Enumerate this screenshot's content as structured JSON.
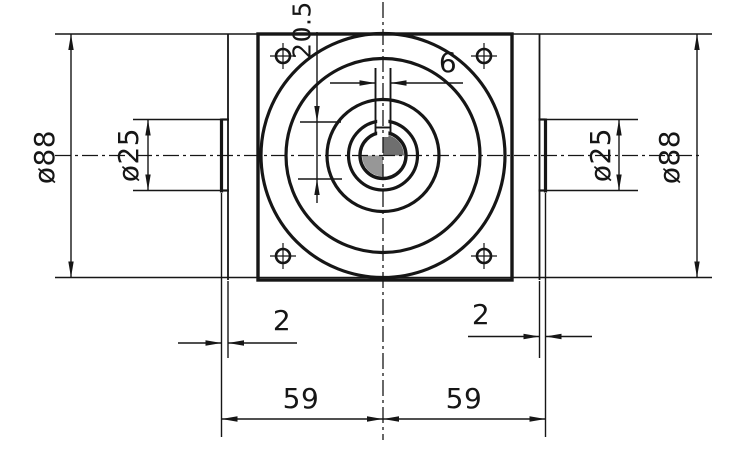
{
  "drawing": {
    "type": "engineering-dimension-drawing",
    "view": "front-view-square-flange-gearbox",
    "labels": {
      "od_left": "ø88",
      "od_right": "ø88",
      "hub_left": "ø25",
      "hub_right": "ø25",
      "keyway_width": "6",
      "keyway_depth": "20.5",
      "step_left": "2",
      "step_right": "2",
      "span_left": "59",
      "span_right": "59"
    },
    "colors": {
      "line": "#161616",
      "background": "#ffffff",
      "bore_shade_dark": "#6f6f6f",
      "bore_shade_light": "#979797"
    }
  }
}
